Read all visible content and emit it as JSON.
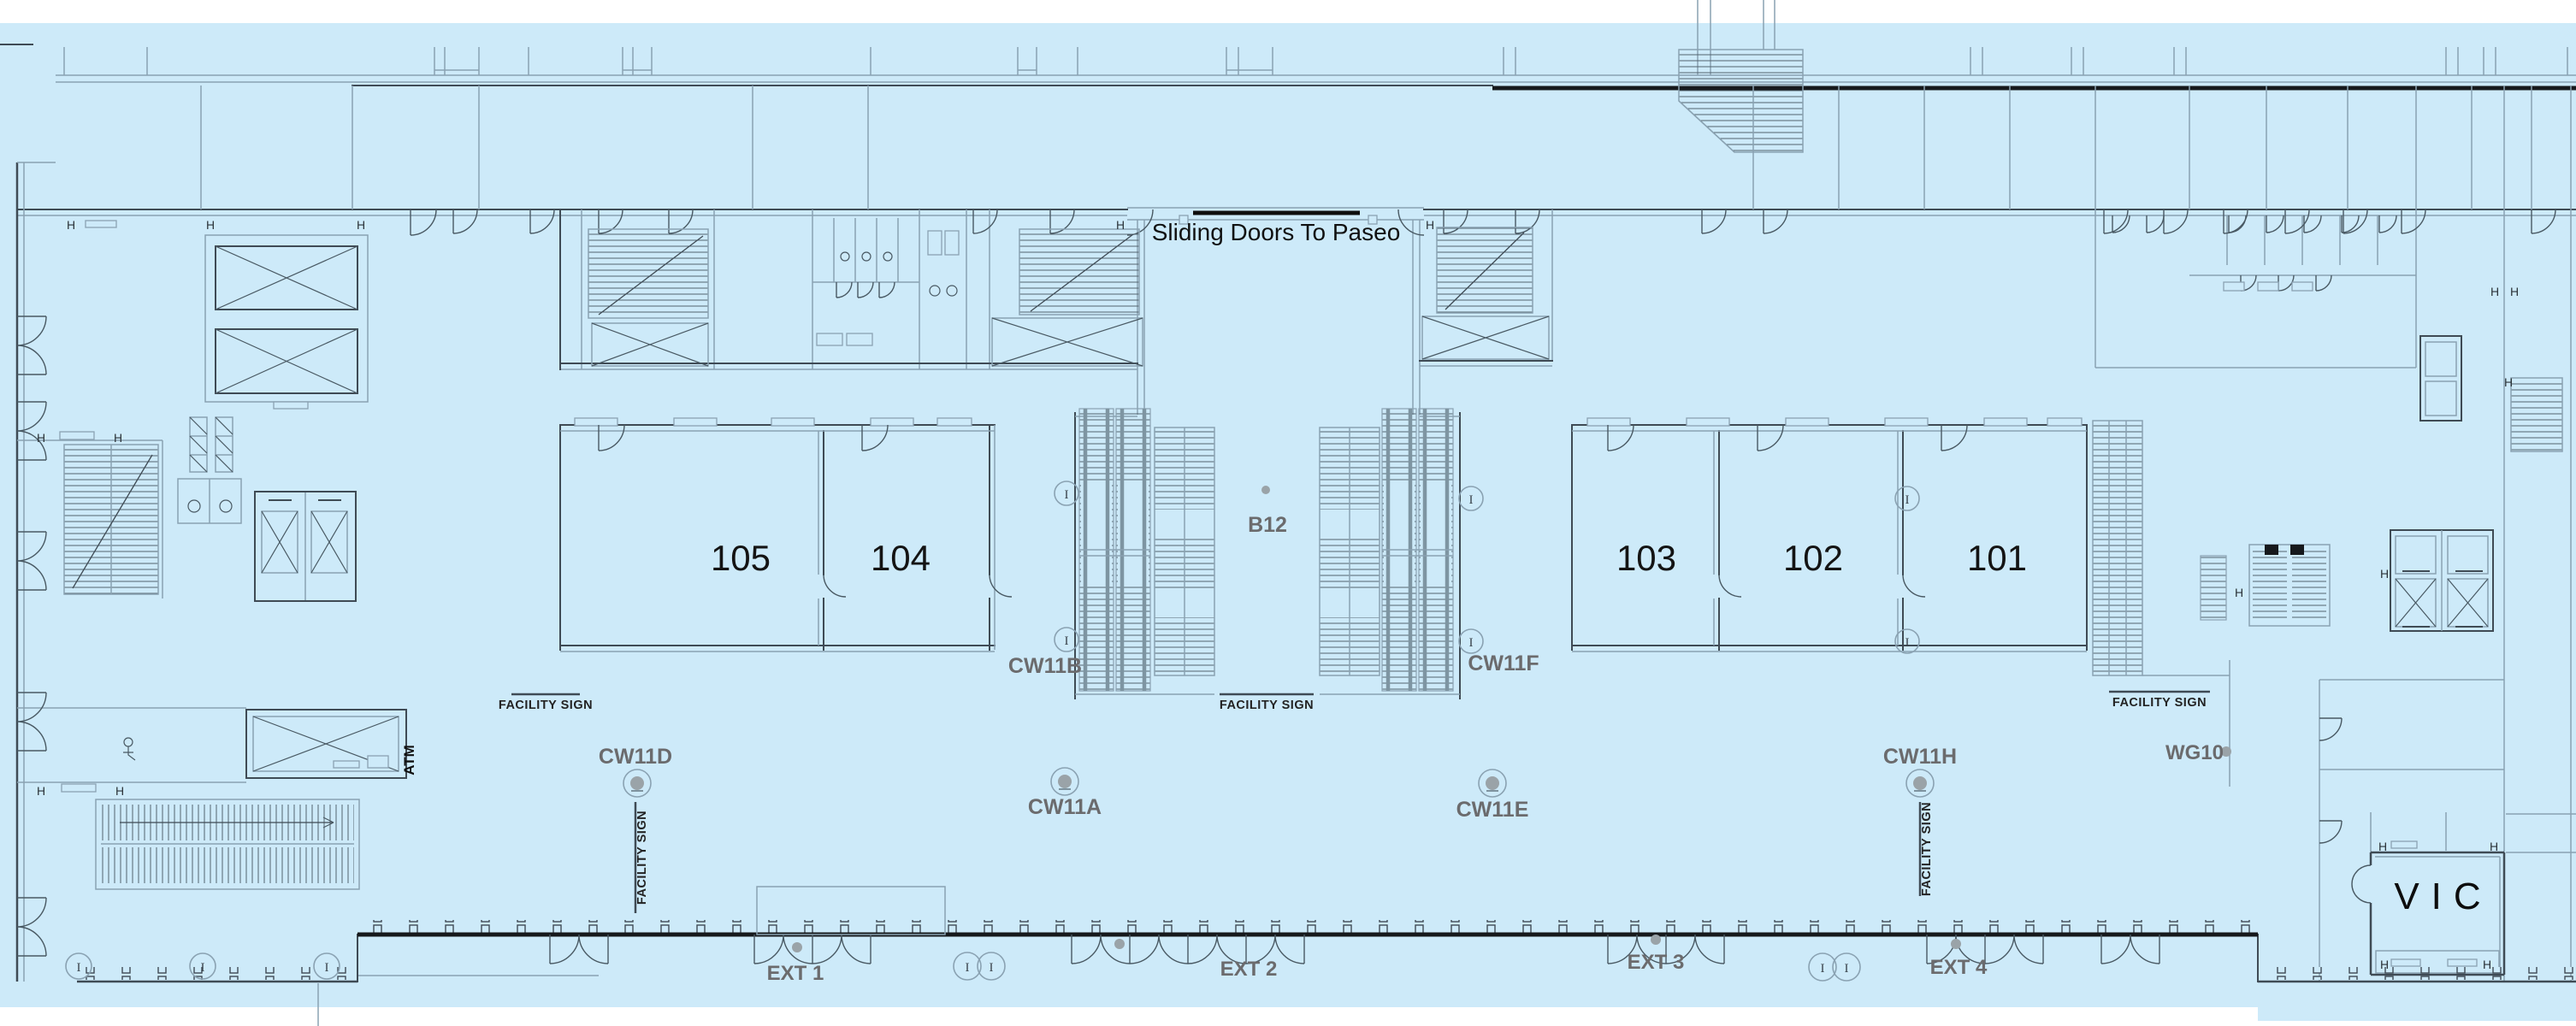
{
  "colors": {
    "background": "#cdeaf9",
    "wall_dark": "#3f4b55",
    "wall_light": "#8aa2b2",
    "wall_heavy": "#16191c",
    "label_gray": "#6b6b6d",
    "label_black": "#141414",
    "dot_gray": "#9aa3a8"
  },
  "annotations": {
    "sliding_doors": "Sliding Doors To Paseo",
    "atm": "ATM"
  },
  "rooms": [
    {
      "label": "105"
    },
    {
      "label": "104"
    },
    {
      "label": "103"
    },
    {
      "label": "102"
    },
    {
      "label": "101"
    }
  ],
  "areas": {
    "b12": "B12",
    "vic": "VIC",
    "wg10": "WG10"
  },
  "circulation": [
    {
      "label": "CW11A"
    },
    {
      "label": "CW11B"
    },
    {
      "label": "CW11D"
    },
    {
      "label": "CW11E"
    },
    {
      "label": "CW11F"
    },
    {
      "label": "CW11H"
    }
  ],
  "exits": [
    {
      "label": "EXT 1"
    },
    {
      "label": "EXT 2"
    },
    {
      "label": "EXT 3"
    },
    {
      "label": "EXT 4"
    }
  ],
  "signs": {
    "facility_sign": "FACILITY SIGN"
  },
  "markers": {
    "column": "I",
    "hardware": "H"
  }
}
